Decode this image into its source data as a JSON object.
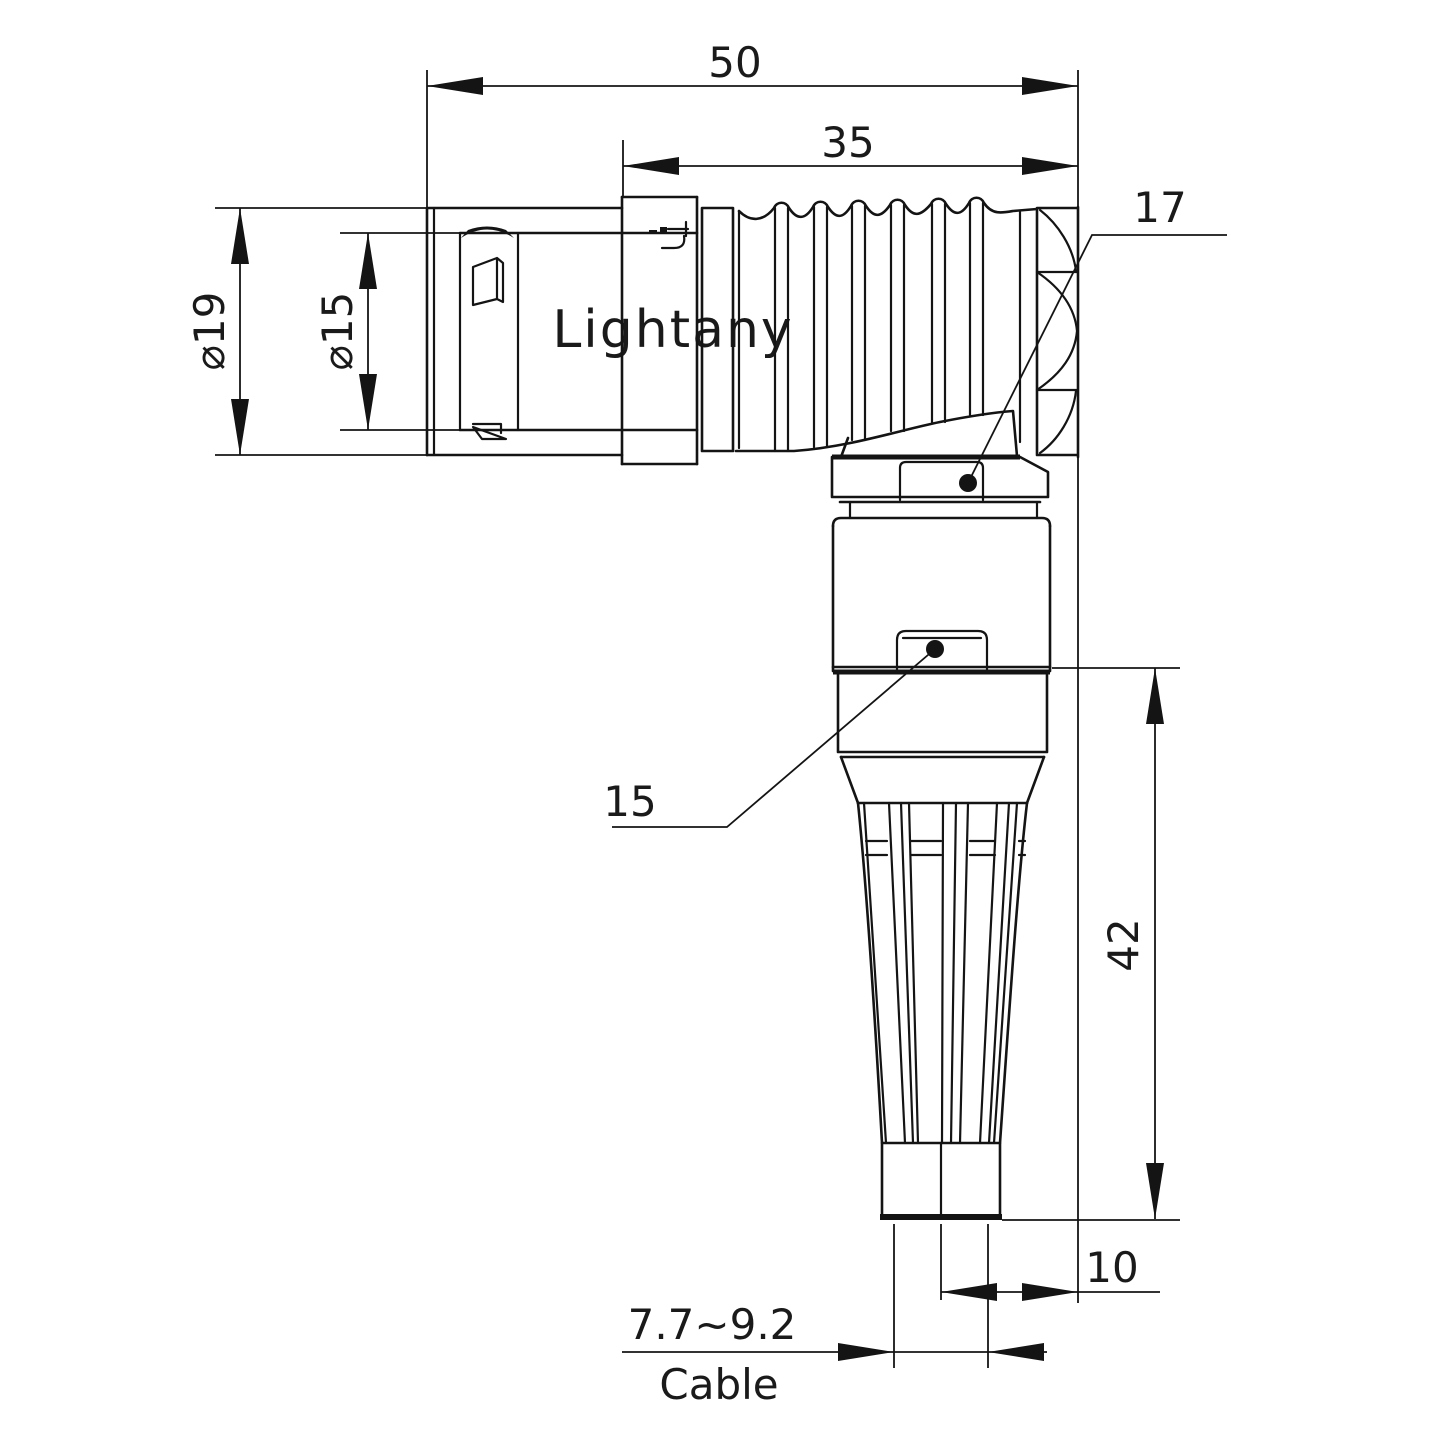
{
  "drawing": {
    "watermark": "Lightany",
    "dim_overall_length": "50",
    "dim_rear_length": "35",
    "dim_outer_diameter": "⌀19",
    "dim_plug_diameter": "⌀15",
    "dim_elbow_nut": "17",
    "dim_body_nut": "15",
    "dim_vertical_length": "42",
    "dim_axis_offset": "10",
    "dim_cable_range": "7.7~9.2",
    "label_cable": "Cable",
    "colors": {
      "line": "#141414",
      "watermark": "#f5c6c6",
      "background": "#ffffff"
    }
  }
}
